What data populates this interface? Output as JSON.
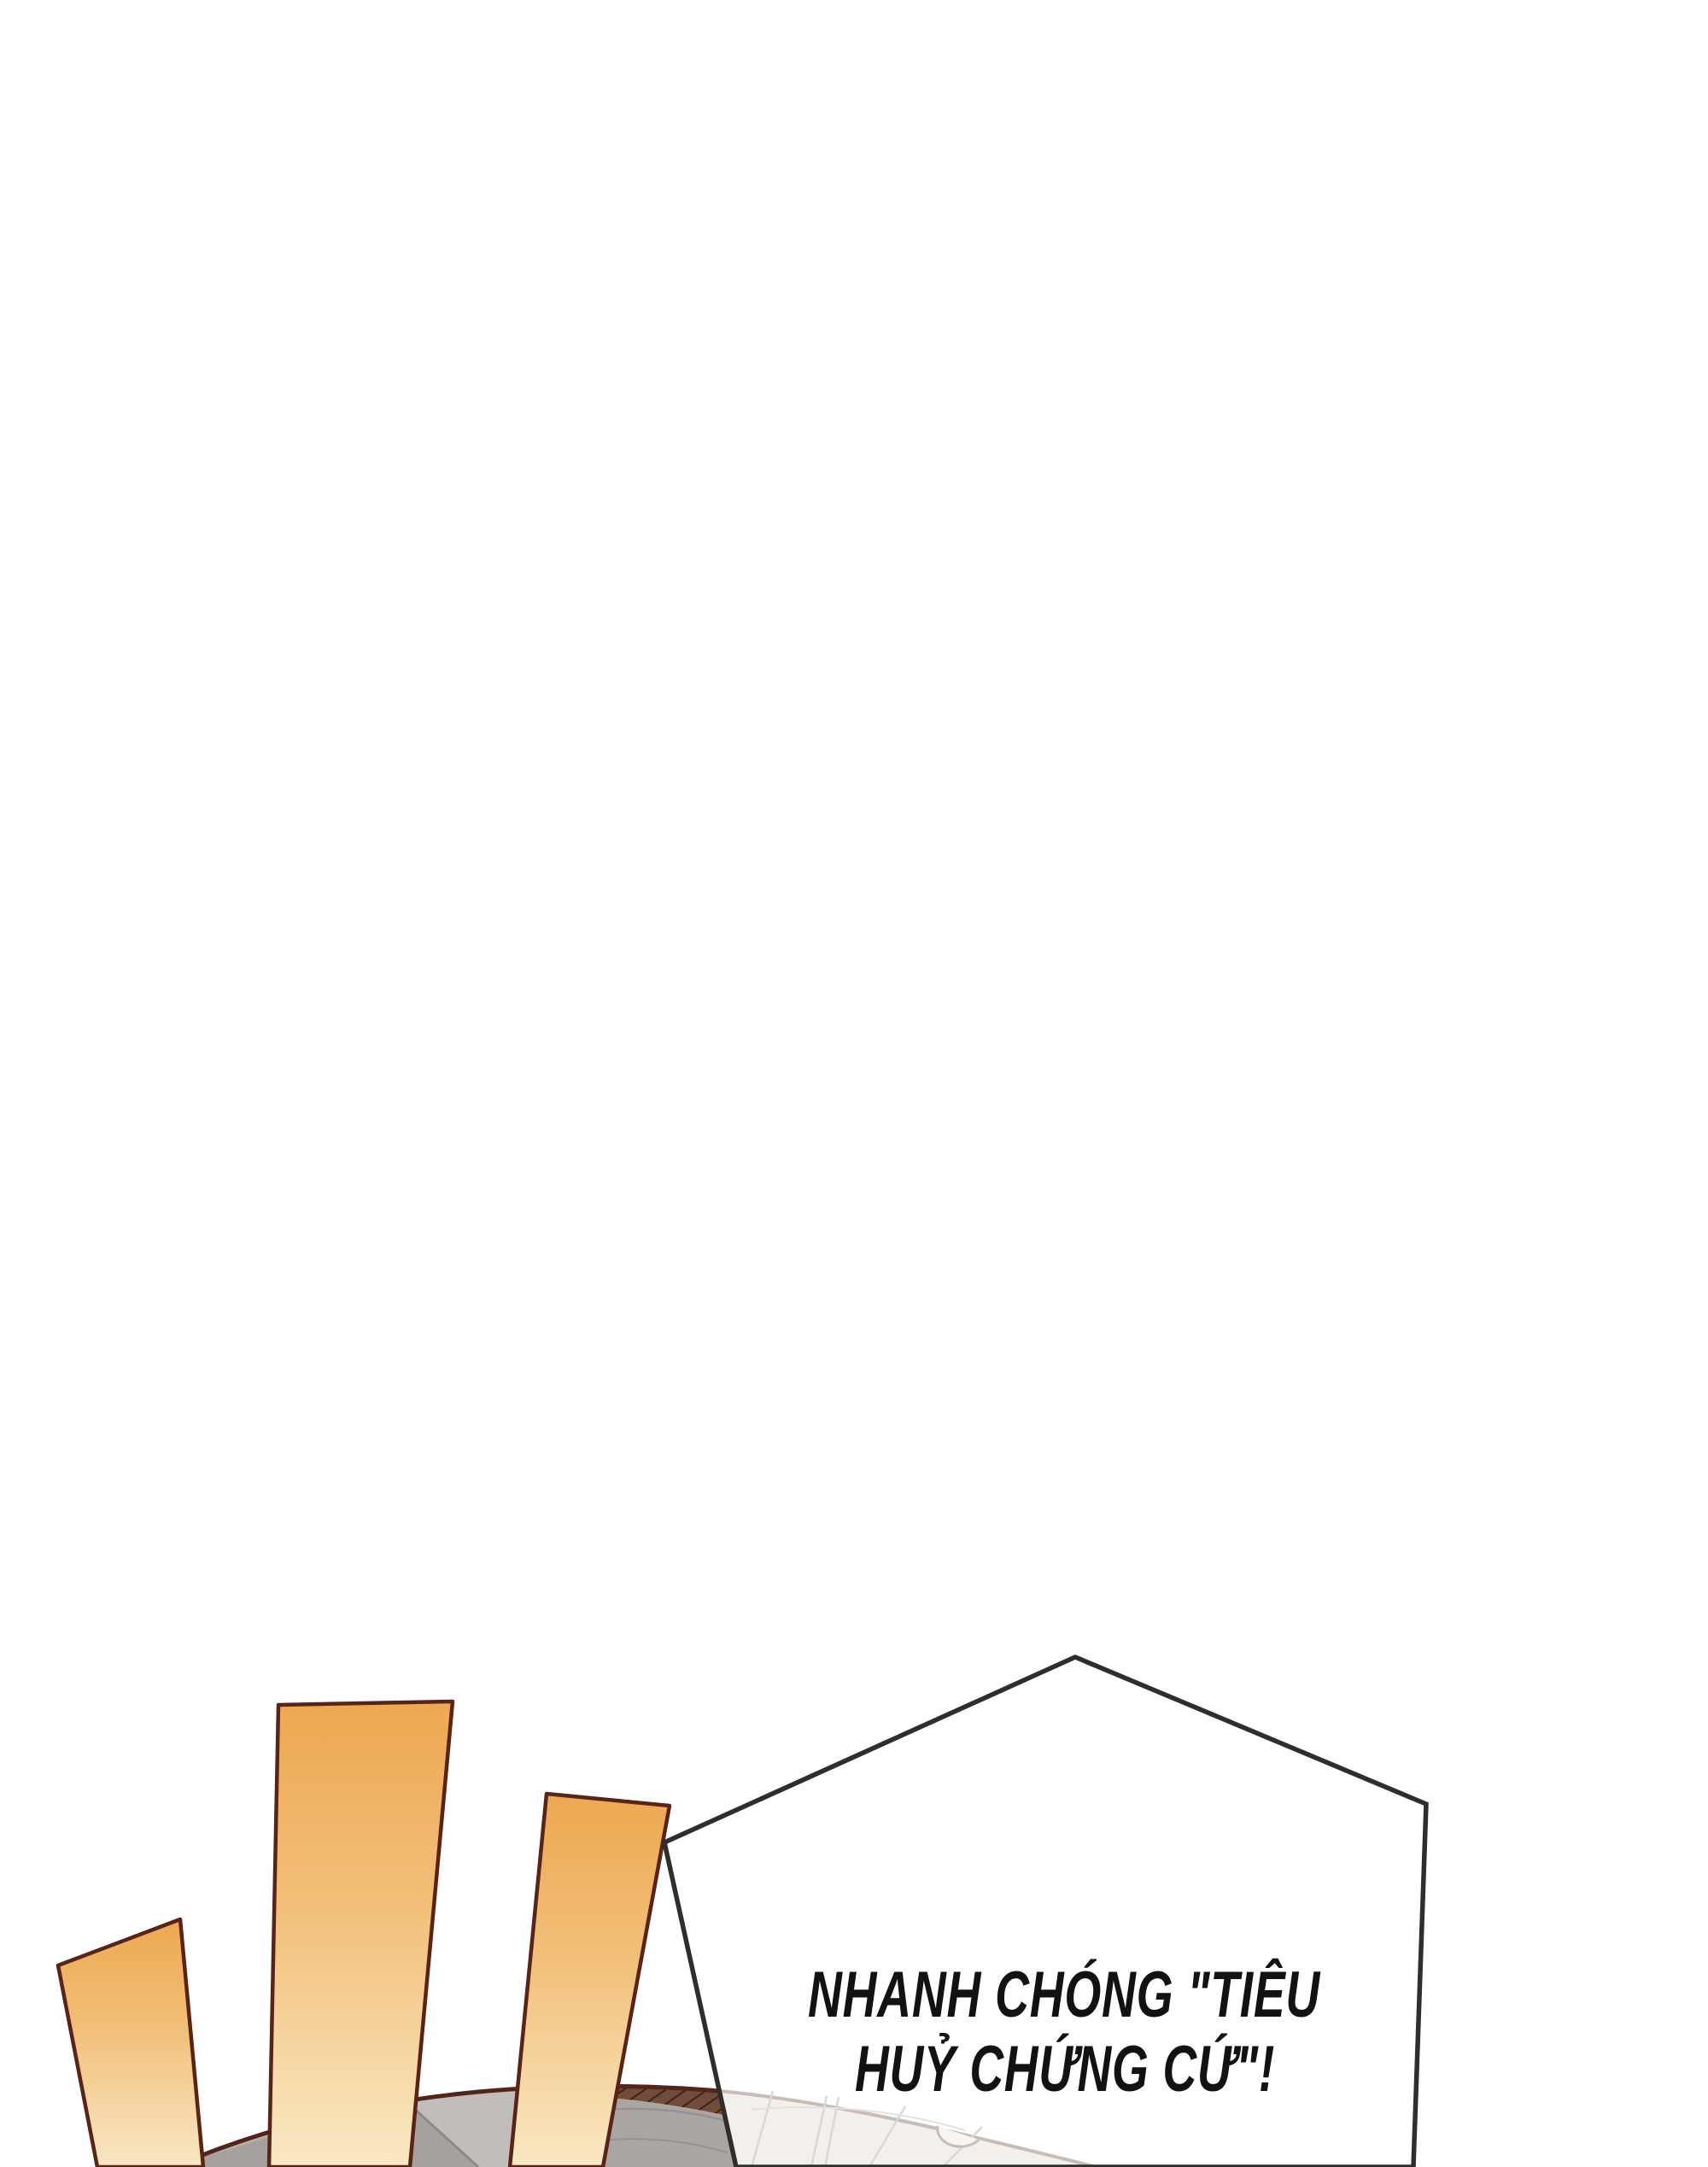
{
  "panel": {
    "type": "comic-panel",
    "background_color": "#ffffff",
    "speech_bubble": {
      "shape": "pentagon",
      "line1": "NHANH CHÓNG \"TIÊU",
      "line2": "HUỶ CHỨNG CỨ\"!",
      "fill": "#ffffff",
      "border_color": "#2e2e2c",
      "text_color": "#121212"
    },
    "emphasis_beams": {
      "count": 3,
      "fill_top": "#eda851",
      "fill_mid": "#f2c07a",
      "fill_bottom": "#f9e8c4",
      "outline_color": "#5a2317"
    },
    "umbrella": {
      "fill": "#b4afac",
      "wedge_dark": "#a6a19e",
      "wedge_light": "#c2bdba",
      "wedge_right": "#aba6a3",
      "outline_color": "#52241a",
      "band_color": "#714c3a",
      "band_hatch_color": "#3f2115",
      "faded_fill": "#f2efed",
      "faded_outline": "#c9bcb6",
      "faded_line_color": "#ddd6d2"
    }
  }
}
